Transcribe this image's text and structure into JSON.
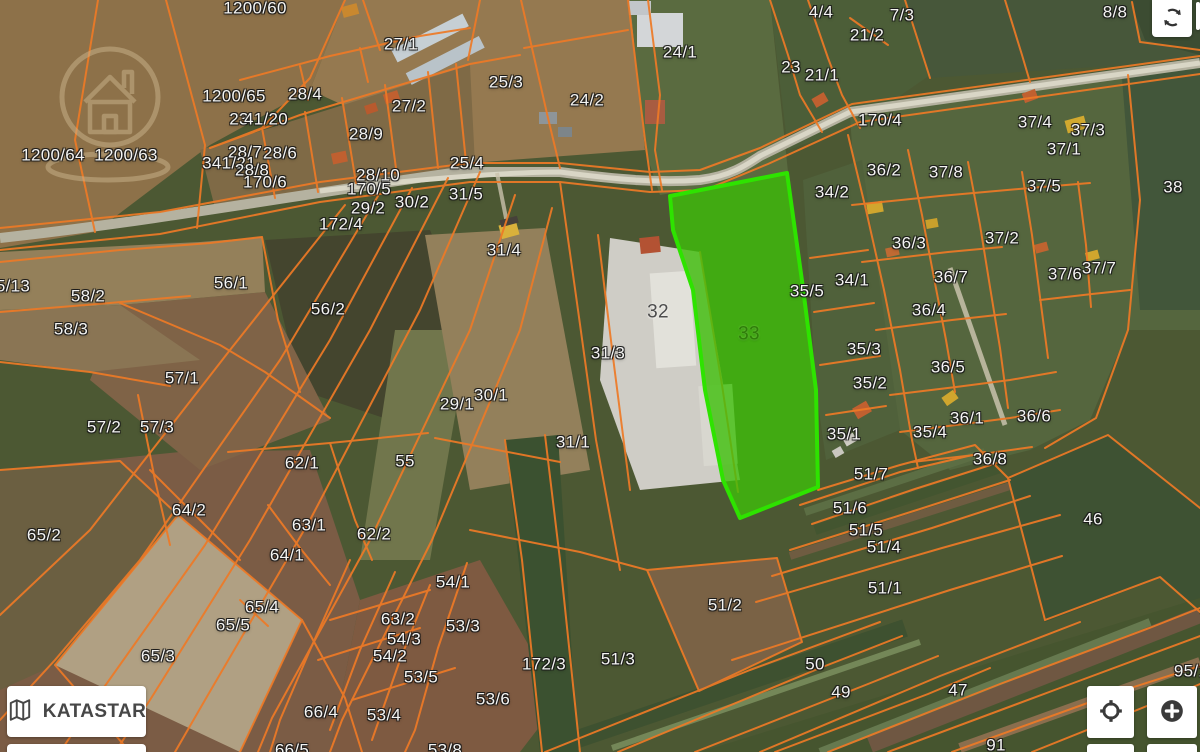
{
  "map": {
    "highlighted_parcel": "33",
    "colors": {
      "boundary": "#ee7a26",
      "highlight_fill": "#3fbf0a",
      "highlight_stroke": "#2ee300",
      "road": "#b5b2a0"
    },
    "labels": [
      {
        "t": "1200/60",
        "x": 255,
        "y": 8
      },
      {
        "t": "27/1",
        "x": 401,
        "y": 44
      },
      {
        "t": "25/3",
        "x": 506,
        "y": 82
      },
      {
        "t": "24/2",
        "x": 587,
        "y": 100
      },
      {
        "t": "24/1",
        "x": 680,
        "y": 52
      },
      {
        "t": "4/4",
        "x": 821,
        "y": 12
      },
      {
        "t": "7/3",
        "x": 902,
        "y": 15
      },
      {
        "t": "8/8",
        "x": 1115,
        "y": 12
      },
      {
        "t": "21/2",
        "x": 867,
        "y": 35
      },
      {
        "t": "23",
        "x": 791,
        "y": 67
      },
      {
        "t": "21/1",
        "x": 822,
        "y": 75
      },
      {
        "t": "1200/65",
        "x": 234,
        "y": 96
      },
      {
        "t": "28/4",
        "x": 305,
        "y": 94
      },
      {
        "t": "27/2",
        "x": 409,
        "y": 106
      },
      {
        "t": "23",
        "x": 239,
        "y": 119
      },
      {
        "t": "41/20",
        "x": 266,
        "y": 119
      },
      {
        "t": "28/9",
        "x": 366,
        "y": 134
      },
      {
        "t": "1200/64",
        "x": 53,
        "y": 155
      },
      {
        "t": "1200/63",
        "x": 126,
        "y": 155
      },
      {
        "t": "28/7",
        "x": 245,
        "y": 152
      },
      {
        "t": "28/6",
        "x": 280,
        "y": 153
      },
      {
        "t": "341/21",
        "x": 229,
        "y": 163
      },
      {
        "t": "28/8",
        "x": 252,
        "y": 170
      },
      {
        "t": "170/6",
        "x": 265,
        "y": 182
      },
      {
        "t": "25/4",
        "x": 467,
        "y": 163
      },
      {
        "t": "28/10",
        "x": 378,
        "y": 175
      },
      {
        "t": "170/5",
        "x": 369,
        "y": 189
      },
      {
        "t": "31/5",
        "x": 466,
        "y": 194
      },
      {
        "t": "30/2",
        "x": 412,
        "y": 202
      },
      {
        "t": "29/2",
        "x": 368,
        "y": 208
      },
      {
        "t": "172/4",
        "x": 341,
        "y": 224
      },
      {
        "t": "170/4",
        "x": 880,
        "y": 120
      },
      {
        "t": "37/4",
        "x": 1035,
        "y": 122
      },
      {
        "t": "37/3",
        "x": 1088,
        "y": 130
      },
      {
        "t": "37/1",
        "x": 1064,
        "y": 149
      },
      {
        "t": "36/2",
        "x": 884,
        "y": 170
      },
      {
        "t": "37/8",
        "x": 946,
        "y": 172
      },
      {
        "t": "37/5",
        "x": 1044,
        "y": 186
      },
      {
        "t": "38",
        "x": 1173,
        "y": 187
      },
      {
        "t": "34/2",
        "x": 832,
        "y": 192
      },
      {
        "t": "36/3",
        "x": 909,
        "y": 243
      },
      {
        "t": "37/2",
        "x": 1002,
        "y": 238
      },
      {
        "t": "36/7",
        "x": 951,
        "y": 277
      },
      {
        "t": "37/6",
        "x": 1065,
        "y": 274
      },
      {
        "t": "37/7",
        "x": 1099,
        "y": 268
      },
      {
        "t": "34/1",
        "x": 852,
        "y": 280
      },
      {
        "t": "35/5",
        "x": 807,
        "y": 291
      },
      {
        "t": "5/13",
        "x": 13,
        "y": 286
      },
      {
        "t": "58/2",
        "x": 88,
        "y": 296
      },
      {
        "t": "56/1",
        "x": 231,
        "y": 283
      },
      {
        "t": "58/3",
        "x": 71,
        "y": 329
      },
      {
        "t": "56/2",
        "x": 328,
        "y": 309
      },
      {
        "t": "31/4",
        "x": 504,
        "y": 250
      },
      {
        "t": "32",
        "x": 658,
        "y": 312,
        "v": "dark"
      },
      {
        "t": "33",
        "x": 749,
        "y": 334,
        "v": "green"
      },
      {
        "t": "36/4",
        "x": 929,
        "y": 310
      },
      {
        "t": "35/3",
        "x": 864,
        "y": 349
      },
      {
        "t": "36/5",
        "x": 948,
        "y": 367
      },
      {
        "t": "35/2",
        "x": 870,
        "y": 383
      },
      {
        "t": "57/1",
        "x": 182,
        "y": 378
      },
      {
        "t": "31/3",
        "x": 608,
        "y": 353
      },
      {
        "t": "30/1",
        "x": 491,
        "y": 395
      },
      {
        "t": "29/1",
        "x": 457,
        "y": 404
      },
      {
        "t": "57/2",
        "x": 104,
        "y": 427
      },
      {
        "t": "57/3",
        "x": 157,
        "y": 427
      },
      {
        "t": "36/1",
        "x": 967,
        "y": 418
      },
      {
        "t": "36/6",
        "x": 1034,
        "y": 416
      },
      {
        "t": "35/4",
        "x": 930,
        "y": 432
      },
      {
        "t": "35/1",
        "x": 844,
        "y": 434
      },
      {
        "t": "36/8",
        "x": 990,
        "y": 459
      },
      {
        "t": "31/1",
        "x": 573,
        "y": 442
      },
      {
        "t": "62/1",
        "x": 302,
        "y": 463
      },
      {
        "t": "55",
        "x": 405,
        "y": 461
      },
      {
        "t": "51/7",
        "x": 871,
        "y": 474
      },
      {
        "t": "64/2",
        "x": 189,
        "y": 510
      },
      {
        "t": "63/1",
        "x": 309,
        "y": 525
      },
      {
        "t": "62/2",
        "x": 374,
        "y": 534
      },
      {
        "t": "51/6",
        "x": 850,
        "y": 508
      },
      {
        "t": "46",
        "x": 1093,
        "y": 519
      },
      {
        "t": "65/2",
        "x": 44,
        "y": 535
      },
      {
        "t": "64/1",
        "x": 287,
        "y": 555
      },
      {
        "t": "51/5",
        "x": 866,
        "y": 530
      },
      {
        "t": "51/4",
        "x": 884,
        "y": 547
      },
      {
        "t": "54/1",
        "x": 453,
        "y": 582
      },
      {
        "t": "51/1",
        "x": 885,
        "y": 588
      },
      {
        "t": "65/4",
        "x": 262,
        "y": 607
      },
      {
        "t": "63/2",
        "x": 398,
        "y": 619
      },
      {
        "t": "65/5",
        "x": 233,
        "y": 625
      },
      {
        "t": "54/3",
        "x": 404,
        "y": 639
      },
      {
        "t": "53/3",
        "x": 463,
        "y": 626
      },
      {
        "t": "51/2",
        "x": 725,
        "y": 605
      },
      {
        "t": "54/2",
        "x": 390,
        "y": 656
      },
      {
        "t": "65/3",
        "x": 158,
        "y": 656
      },
      {
        "t": "172/3",
        "x": 544,
        "y": 664
      },
      {
        "t": "51/3",
        "x": 618,
        "y": 659
      },
      {
        "t": "50",
        "x": 815,
        "y": 664
      },
      {
        "t": "53/5",
        "x": 421,
        "y": 677
      },
      {
        "t": "49",
        "x": 841,
        "y": 692
      },
      {
        "t": "47",
        "x": 958,
        "y": 690
      },
      {
        "t": "53/6",
        "x": 493,
        "y": 699
      },
      {
        "t": "66/4",
        "x": 321,
        "y": 712
      },
      {
        "t": "53/4",
        "x": 384,
        "y": 715
      },
      {
        "t": "95/1",
        "x": 1191,
        "y": 671
      },
      {
        "t": "91",
        "x": 996,
        "y": 745
      },
      {
        "t": "66/5",
        "x": 292,
        "y": 750
      },
      {
        "t": "53/8",
        "x": 445,
        "y": 750
      }
    ]
  },
  "controls": {
    "katastar_label": "KATASTAR",
    "icons": {
      "refresh": "refresh-icon",
      "map": "map-icon",
      "locate": "locate-icon",
      "zoom_in": "plus-icon"
    }
  }
}
